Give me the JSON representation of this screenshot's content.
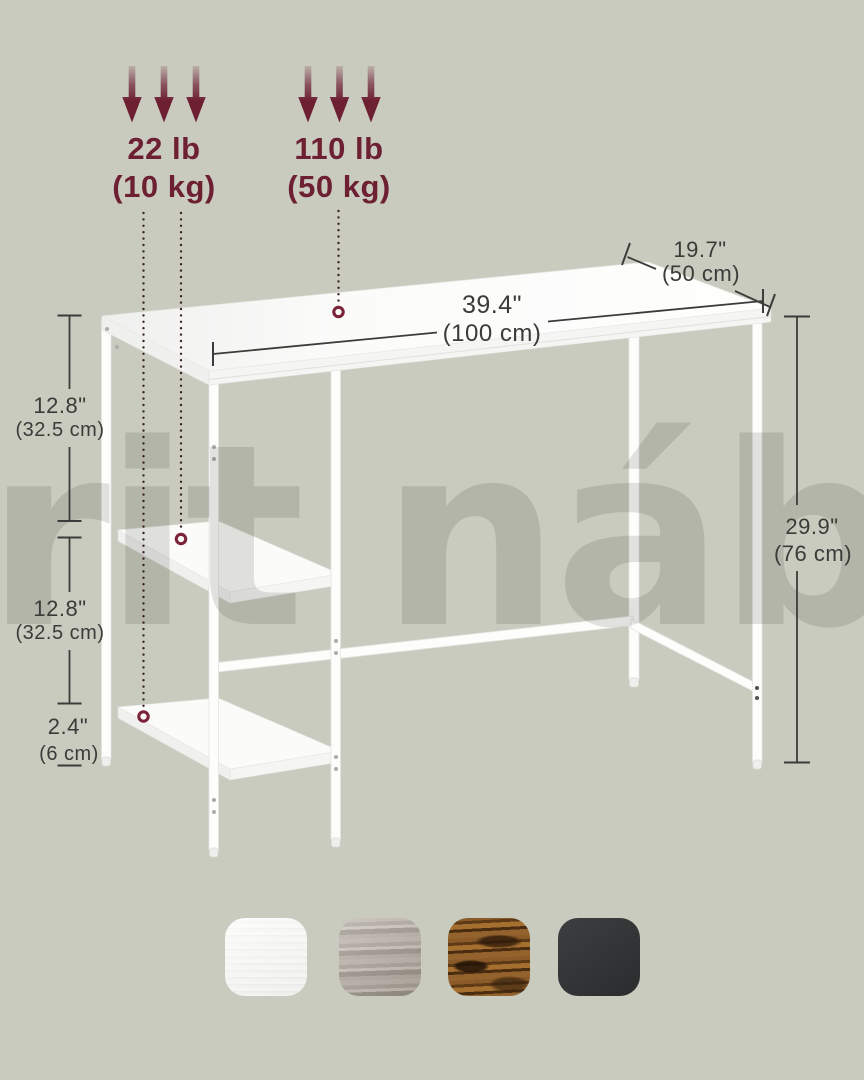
{
  "watermark": {
    "text": "rit náby"
  },
  "load_capacity": {
    "shelf": {
      "pounds": "22 lb",
      "kilograms": "(10 kg)"
    },
    "tabletop": {
      "pounds": "110 lb",
      "kilograms": "(50 kg)"
    }
  },
  "dimensions": {
    "tabletop_width": {
      "inches": "39.4\"",
      "metric": "(100 cm)"
    },
    "tabletop_depth": {
      "inches": "19.7\"",
      "metric": "(50 cm)"
    },
    "desk_height": {
      "inches": "29.9\"",
      "metric": "(76 cm)"
    },
    "upper_shelf_spacing": {
      "inches": "12.8\"",
      "metric": "(32.5 cm)"
    },
    "lower_shelf_spacing": {
      "inches": "12.8\"",
      "metric": "(32.5 cm)"
    },
    "bottom_shelf_clearance": {
      "inches": "2.4\"",
      "metric": "(6 cm)"
    }
  },
  "colors": {
    "background": "#c8cbbe",
    "accent_maroon": "#6e2033",
    "dimension_text": "#3b3b39",
    "desk_white": "#fdfdfc"
  },
  "swatches": [
    {
      "name": "white wood"
    },
    {
      "name": "greige wood"
    },
    {
      "name": "rustic brown wood"
    },
    {
      "name": "black"
    }
  ]
}
